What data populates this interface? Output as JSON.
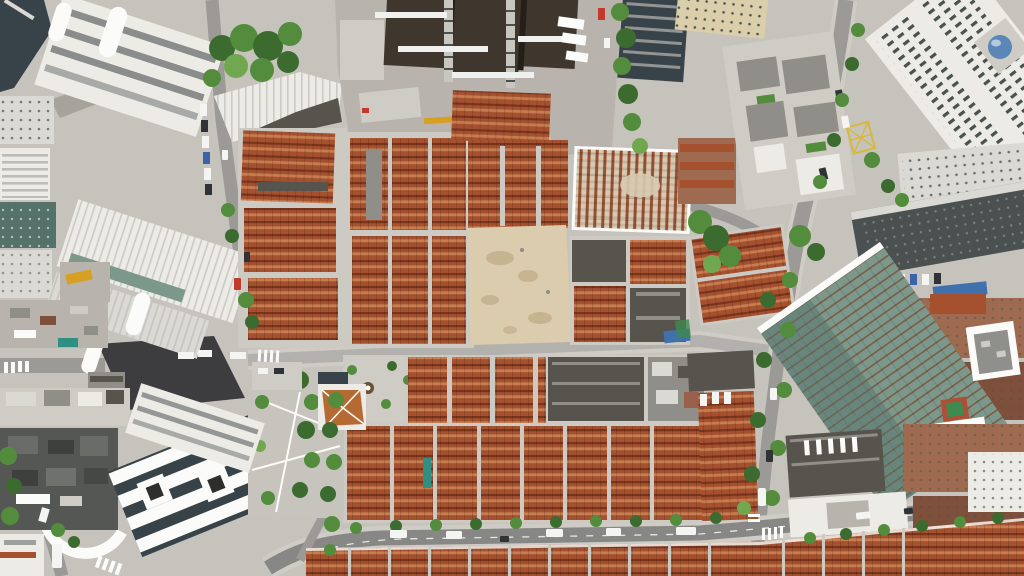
{
  "scene": {
    "type": "aerial-drone-photograph",
    "description": "Top-down daytime aerial photograph of a dense urban district: historic red-tile-roof lane-house (shikumen) blocks in the center, an active construction and demolition site with dark high-rise cores and crane masts at top center, a sand-colored cleared lot in the middle, a roofless block under renovation showing tan decking with red joists, modern white office slabs to the west, glass skyscrapers to the east, a green-glass tower and brick mid-rises to the southeast, a white ribbed-roof complex to the southwest, and tree-lined streets with vehicles, crosswalks and a yellow hatched junction box.",
    "time_of_day": "daytime",
    "no_visible_text": true,
    "features": [
      "red-tiled lane-house rows separated by light gray lanes",
      "construction site with two crane masts and white tie beams",
      "yellow crane boom and green material piles",
      "cleared sandy demolition lot with soil stains",
      "scaffolded roofless block with red rafter stripes",
      "tree-lined north-south street with yellow cross-hatch box marking",
      "white trucks and a bus on the southern road",
      "zebra crosswalks at intersections",
      "rooftop sports court and rooftop vent fans",
      "curved white access ramp at the southwest",
      "blue glass dome atrium on an east tower",
      "blue tarpaulins on roofs"
    ]
  },
  "palette": {
    "ground": "#c6c3bc",
    "concrete": "#b8b4ad",
    "concrete_light": "#cfccc5",
    "road": "#9b9a97",
    "road_light": "#b2b1ad",
    "road_dark": "#878785",
    "asphalt_new": "#3d3d40",
    "lane": "#cdcac3",
    "roof_red": "#a5512f",
    "roof_red_light": "#c77d50",
    "roof_red_dark": "#78351c",
    "roof_dark": "#56544d",
    "roof_gray": "#908e88",
    "sand": "#dcccae",
    "sand_stain": "#c2ae8b",
    "tree_dark": "#3c6b2f",
    "tree_mid": "#538c3c",
    "tree_light": "#71a84f",
    "bldg_white": "#edebe6",
    "bldg_white2": "#dbd9d3",
    "white_pure": "#fbfbf9",
    "win_dark": "#49514f",
    "glass_dark": "#384349",
    "glass_green": "#7b988a",
    "glass_green_dark": "#54716a",
    "mullion": "#7d5b45",
    "scaffold_tan": "#d7cab1",
    "scaffold_red": "#9c4e32",
    "tower_dark": "#3f372d",
    "crane_gray": "#c9c6c0",
    "crane_yellow": "#d7a022",
    "beam": "#eff1ef",
    "tarp_blue": "#4071ad",
    "dome_blue": "#5b87b8",
    "court_green": "#3f8a4f",
    "court_red": "#ad5037",
    "brick": "#9e6a50",
    "brick_dark": "#7e4f3a",
    "veh_white": "#f4f4f2",
    "veh_dark": "#2f3336",
    "veh_red": "#c13a2c",
    "veh_blue": "#3a63a9",
    "mark_yellow": "#d7b83c",
    "teal": "#2f8f83",
    "shadow": "rgba(0,0,0,0.16)"
  },
  "regions": [
    {
      "id": "construction-site",
      "desc": "Construction/demolition site with dark tower cores and cranes, top center"
    },
    {
      "id": "cleared-lot",
      "desc": "Sand-colored cleared lot, center"
    },
    {
      "id": "old-town-north",
      "desc": "Red-tile lane-house blocks north of the middle road"
    },
    {
      "id": "old-town-south",
      "desc": "Red-tile lane-house blocks south of the middle road"
    },
    {
      "id": "scaffolded-block",
      "desc": "Roofless block under renovation, tan deck with red joists"
    },
    {
      "id": "office-slabs-west",
      "desc": "White office slab towers, northwest"
    },
    {
      "id": "skyscrapers-east",
      "desc": "High-rise towers along the east edge"
    },
    {
      "id": "green-glass-tower",
      "desc": "Green glass tower, southeast"
    },
    {
      "id": "ribbed-complex-southwest",
      "desc": "White ribbed-roof modern complex, southwest"
    },
    {
      "id": "road-network",
      "desc": "Tree-lined streets with vehicles and crosswalks"
    }
  ]
}
